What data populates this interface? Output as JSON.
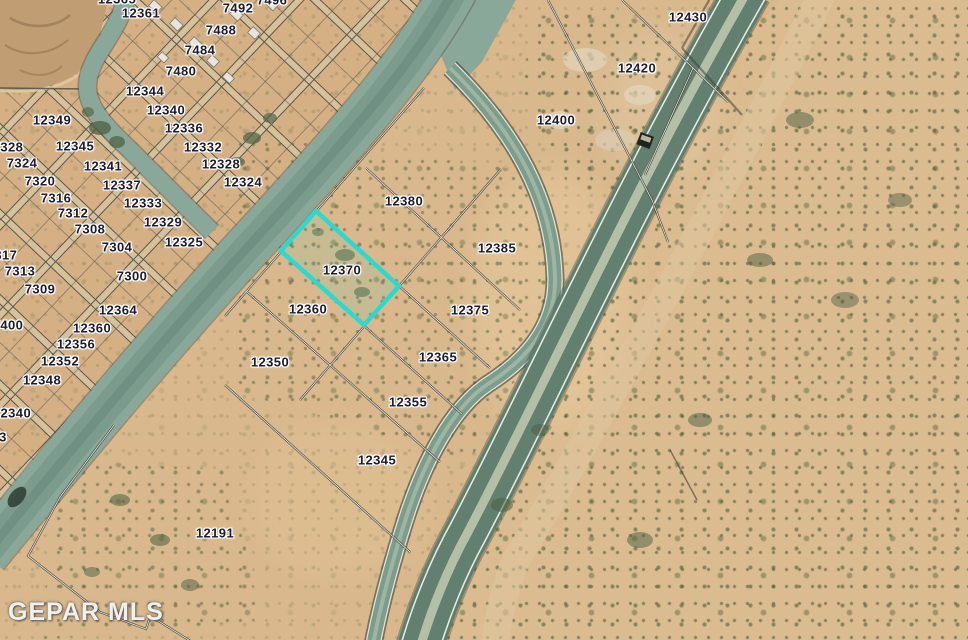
{
  "app": {
    "type": "aerial-parcel-map",
    "watermark": "GEPAR MLS"
  },
  "map": {
    "highlight": {
      "parcel": "12370",
      "color": "#2bd9cf",
      "fill": "rgba(43,217,207,0.10)"
    },
    "palette": {
      "desert": "#d9b88d",
      "subdivision_tint": "#d2a87e",
      "road": "#8aa89a",
      "highway_lanes": "#5f8070",
      "highway_median": "#b3c0a7",
      "shrub": "#4c5f42",
      "label_text": "#1c1c2e",
      "label_halo": "#ffffff"
    },
    "labels": [
      {
        "text": "12365",
        "x": 117,
        "y": -1
      },
      {
        "text": "12361",
        "x": 141,
        "y": 13
      },
      {
        "text": "7496",
        "x": 272,
        "y": 0
      },
      {
        "text": "7492",
        "x": 238,
        "y": 8
      },
      {
        "text": "7488",
        "x": 221,
        "y": 30
      },
      {
        "text": "7484",
        "x": 200,
        "y": 50
      },
      {
        "text": "7480",
        "x": 181,
        "y": 71
      },
      {
        "text": "12344",
        "x": 145,
        "y": 91
      },
      {
        "text": "12340",
        "x": 166,
        "y": 110
      },
      {
        "text": "12336",
        "x": 184,
        "y": 128
      },
      {
        "text": "12332",
        "x": 203,
        "y": 147
      },
      {
        "text": "12328",
        "x": 221,
        "y": 164
      },
      {
        "text": "12324",
        "x": 243,
        "y": 182
      },
      {
        "text": "12349",
        "x": 52,
        "y": 120
      },
      {
        "text": "12345",
        "x": 75,
        "y": 146
      },
      {
        "text": "12341",
        "x": 103,
        "y": 166
      },
      {
        "text": "12337",
        "x": 122,
        "y": 185
      },
      {
        "text": "12333",
        "x": 143,
        "y": 203
      },
      {
        "text": "12329",
        "x": 163,
        "y": 222
      },
      {
        "text": "12325",
        "x": 184,
        "y": 242
      },
      {
        "text": "7328",
        "x": 8,
        "y": 147
      },
      {
        "text": "7324",
        "x": 22,
        "y": 163
      },
      {
        "text": "7320",
        "x": 40,
        "y": 181
      },
      {
        "text": "7316",
        "x": 56,
        "y": 198
      },
      {
        "text": "7312",
        "x": 73,
        "y": 213
      },
      {
        "text": "7308",
        "x": 90,
        "y": 229
      },
      {
        "text": "7304",
        "x": 117,
        "y": 247
      },
      {
        "text": "7300",
        "x": 132,
        "y": 276
      },
      {
        "text": "7317",
        "x": 2,
        "y": 255
      },
      {
        "text": "7313",
        "x": 20,
        "y": 271
      },
      {
        "text": "7309",
        "x": 40,
        "y": 289
      },
      {
        "text": "7400",
        "x": 8,
        "y": 325
      },
      {
        "text": "12364",
        "x": 118,
        "y": 310
      },
      {
        "text": "12360",
        "x": 92,
        "y": 328
      },
      {
        "text": "12356",
        "x": 76,
        "y": 344
      },
      {
        "text": "12352",
        "x": 60,
        "y": 361
      },
      {
        "text": "12348",
        "x": 42,
        "y": 380
      },
      {
        "text": "12340",
        "x": 12,
        "y": 413
      },
      {
        "text": "3",
        "x": 3,
        "y": 437
      },
      {
        "text": "12380",
        "x": 404,
        "y": 201
      },
      {
        "text": "12385",
        "x": 497,
        "y": 248
      },
      {
        "text": "12370",
        "x": 342,
        "y": 270
      },
      {
        "text": "12360",
        "x": 308,
        "y": 309
      },
      {
        "text": "12375",
        "x": 470,
        "y": 310
      },
      {
        "text": "12350",
        "x": 270,
        "y": 362
      },
      {
        "text": "12365",
        "x": 438,
        "y": 357
      },
      {
        "text": "12355",
        "x": 408,
        "y": 402
      },
      {
        "text": "12345",
        "x": 377,
        "y": 460
      },
      {
        "text": "12191",
        "x": 215,
        "y": 533
      },
      {
        "text": "12430",
        "x": 688,
        "y": 17
      },
      {
        "text": "12420",
        "x": 637,
        "y": 68
      },
      {
        "text": "12400",
        "x": 556,
        "y": 120
      }
    ]
  }
}
